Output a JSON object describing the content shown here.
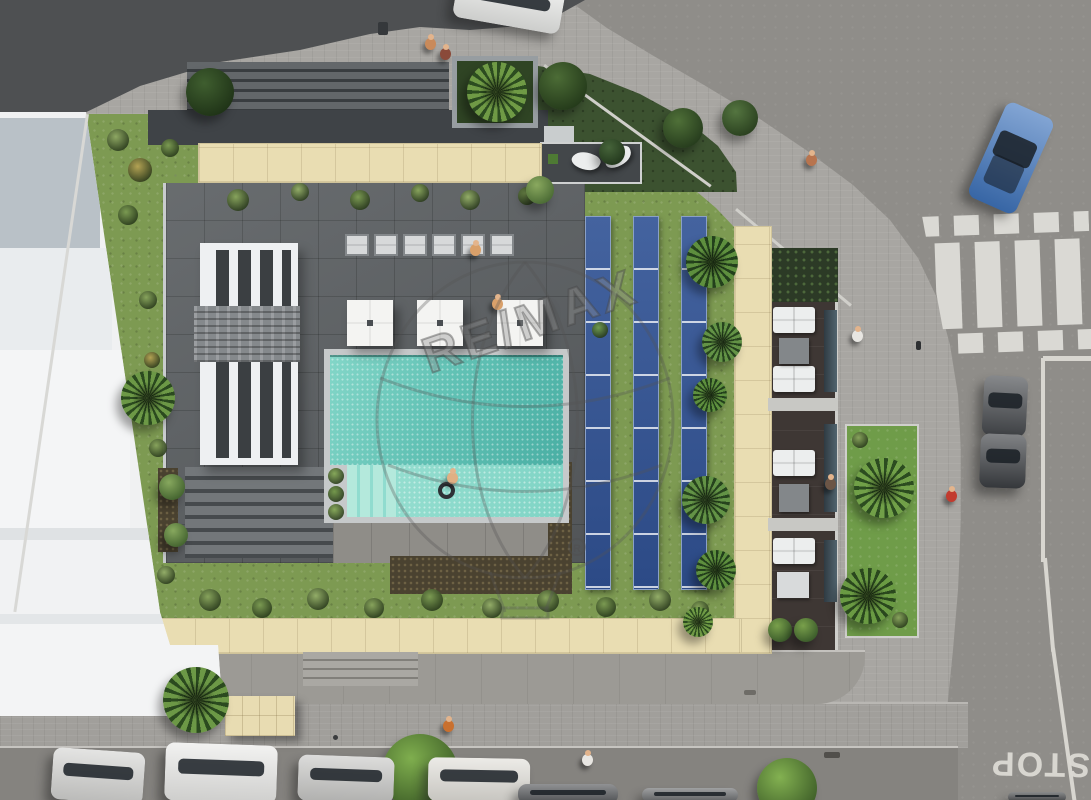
{
  "meta": {
    "description": "Aerial 3D rendering of a residential building with rooftop pool courtyard, solar panels, gardens, sidewalks and street",
    "watermark_text": "RE/MAX",
    "registered_symbol": "R"
  },
  "road_markings": {
    "stop_label": "STOP"
  },
  "palette": {
    "road_asphalt": "#8f8d89",
    "dark_asphalt": "#4e5052",
    "sidewalk": "#a8a6a2",
    "grass_light": "#7d9a52",
    "grass_dark": "#3c5230",
    "beige_tile": "#e9ddb2",
    "pool_deep": "#4aafa4",
    "pool_shallow": "#7fd4c5",
    "deck_tile": "#5d6164",
    "solar_blue": "#35549a",
    "crosswalk_red": "#b76156",
    "marking_white": "#dad9d4",
    "building_white": "#f0f1f2",
    "car_blue": "#3f74bc"
  },
  "crosswalk": {
    "bar_xs": [
      20,
      60,
      100,
      140
    ],
    "square_xs": [
      0,
      40,
      80,
      120,
      160
    ],
    "red": "#b76156",
    "white": "#dad9d4"
  },
  "solar": {
    "strip_xs": [
      585,
      633,
      681
    ],
    "y": 216
  },
  "umbrellas": [
    {
      "x": 347,
      "y": 300
    },
    {
      "x": 417,
      "y": 300
    },
    {
      "x": 497,
      "y": 300
    }
  ],
  "loungers": {
    "y": 234,
    "xs": [
      345,
      374,
      403,
      432,
      461,
      490
    ]
  },
  "leaf_loungers": [
    {
      "x": 572,
      "y": 152,
      "rot": 25
    },
    {
      "x": 604,
      "y": 148,
      "rot": -20
    }
  ],
  "balcony": {
    "sofas": [
      {
        "x": 773,
        "y": 307
      },
      {
        "x": 773,
        "y": 366
      },
      {
        "x": 773,
        "y": 450
      },
      {
        "x": 773,
        "y": 538
      }
    ],
    "tables": [
      {
        "x": 779,
        "y": 338,
        "w": 30,
        "h": 26,
        "c": "#83878a"
      },
      {
        "x": 779,
        "y": 484,
        "w": 30,
        "h": 28,
        "c": "#83878a"
      },
      {
        "x": 777,
        "y": 572,
        "w": 32,
        "h": 26,
        "c": "#d8dadb"
      }
    ],
    "glass": [
      {
        "y": 310,
        "h": 82
      },
      {
        "y": 424,
        "h": 88
      },
      {
        "y": 540,
        "h": 62
      }
    ],
    "walls_y": [
      398,
      518
    ]
  },
  "trees": [
    {
      "x": 210,
      "y": 92,
      "r": 24,
      "kind": "bush",
      "c1": "#3f5e2f",
      "c2": "#1f3317"
    },
    {
      "x": 563,
      "y": 86,
      "r": 24,
      "kind": "bush",
      "c1": "#4c6c36",
      "c2": "#243a1a"
    },
    {
      "x": 612,
      "y": 152,
      "r": 13,
      "kind": "bush",
      "c1": "#46643a",
      "c2": "#22371c"
    },
    {
      "x": 683,
      "y": 128,
      "r": 20,
      "kind": "bush",
      "c1": "#4f7038",
      "c2": "#263c1d"
    },
    {
      "x": 740,
      "y": 118,
      "r": 18,
      "kind": "bush",
      "c1": "#547540",
      "c2": "#2a401f"
    },
    {
      "x": 497,
      "y": 92,
      "r": 30,
      "kind": "palm",
      "c1": "#6f9a45",
      "c2": "#2c4c20"
    },
    {
      "x": 148,
      "y": 398,
      "r": 27,
      "kind": "palm",
      "c1": "#6c9846",
      "c2": "#2b4a1f"
    },
    {
      "x": 172,
      "y": 487,
      "r": 13,
      "kind": "bush",
      "c1": "#87a85e",
      "c2": "#43632f"
    },
    {
      "x": 176,
      "y": 535,
      "r": 12,
      "kind": "bush",
      "c1": "#87a85e",
      "c2": "#43632f"
    },
    {
      "x": 712,
      "y": 262,
      "r": 26,
      "kind": "palm",
      "c1": "#5e8f3e",
      "c2": "#23401c"
    },
    {
      "x": 722,
      "y": 342,
      "r": 20,
      "kind": "palm",
      "c1": "#639346",
      "c2": "#27441e"
    },
    {
      "x": 710,
      "y": 395,
      "r": 17,
      "kind": "palm",
      "c1": "#5e8f3e",
      "c2": "#23401c"
    },
    {
      "x": 706,
      "y": 500,
      "r": 24,
      "kind": "palm",
      "c1": "#639346",
      "c2": "#27441e"
    },
    {
      "x": 716,
      "y": 570,
      "r": 20,
      "kind": "palm",
      "c1": "#5e8f3e",
      "c2": "#23401c"
    },
    {
      "x": 698,
      "y": 622,
      "r": 15,
      "kind": "palm",
      "c1": "#6f9a45",
      "c2": "#2c4c20"
    },
    {
      "x": 884,
      "y": 488,
      "r": 30,
      "kind": "palm",
      "c1": "#71a048",
      "c2": "#2c4c20"
    },
    {
      "x": 868,
      "y": 596,
      "r": 28,
      "kind": "palm",
      "c1": "#6a9a43",
      "c2": "#2a481e"
    },
    {
      "x": 196,
      "y": 700,
      "r": 33,
      "kind": "palm",
      "c1": "#6c9846",
      "c2": "#2b4a1f"
    },
    {
      "x": 420,
      "y": 772,
      "r": 38,
      "kind": "tree",
      "c1": "#7fae4e",
      "c2": "#3c5c26"
    },
    {
      "x": 787,
      "y": 788,
      "r": 30,
      "kind": "tree",
      "c1": "#83b151",
      "c2": "#3e5e28"
    },
    {
      "x": 540,
      "y": 190,
      "r": 14,
      "kind": "bush",
      "c1": "#8aa95f",
      "c2": "#4a6a34"
    },
    {
      "x": 780,
      "y": 630,
      "r": 12,
      "kind": "bush",
      "c1": "#79a04b",
      "c2": "#3a5a2a"
    },
    {
      "x": 806,
      "y": 630,
      "r": 12,
      "kind": "bush",
      "c1": "#79a04b",
      "c2": "#3a5a2a"
    }
  ],
  "shrubs": [
    {
      "x": 118,
      "y": 140,
      "r": 11,
      "c": "#8ea763"
    },
    {
      "x": 140,
      "y": 170,
      "r": 12,
      "c": "#b3a254"
    },
    {
      "x": 170,
      "y": 148,
      "r": 9,
      "c": "#7b9a52"
    },
    {
      "x": 128,
      "y": 215,
      "r": 10,
      "c": "#7b9a52"
    },
    {
      "x": 238,
      "y": 200,
      "r": 11,
      "c": "#87a35c"
    },
    {
      "x": 300,
      "y": 192,
      "r": 9,
      "c": "#93ad68"
    },
    {
      "x": 360,
      "y": 200,
      "r": 10,
      "c": "#7b9a52"
    },
    {
      "x": 420,
      "y": 193,
      "r": 9,
      "c": "#87a35c"
    },
    {
      "x": 470,
      "y": 200,
      "r": 10,
      "c": "#93ad68"
    },
    {
      "x": 527,
      "y": 196,
      "r": 9,
      "c": "#7b9a52"
    },
    {
      "x": 148,
      "y": 300,
      "r": 9,
      "c": "#87a35c"
    },
    {
      "x": 152,
      "y": 360,
      "r": 8,
      "c": "#b3a254"
    },
    {
      "x": 158,
      "y": 448,
      "r": 9,
      "c": "#87a35c"
    },
    {
      "x": 166,
      "y": 575,
      "r": 9,
      "c": "#93ad68"
    },
    {
      "x": 210,
      "y": 600,
      "r": 11,
      "c": "#87a35c"
    },
    {
      "x": 262,
      "y": 608,
      "r": 10,
      "c": "#7b9a52"
    },
    {
      "x": 318,
      "y": 599,
      "r": 11,
      "c": "#93ad68"
    },
    {
      "x": 374,
      "y": 608,
      "r": 10,
      "c": "#87a35c"
    },
    {
      "x": 432,
      "y": 600,
      "r": 11,
      "c": "#7b9a52"
    },
    {
      "x": 492,
      "y": 608,
      "r": 10,
      "c": "#93ad68"
    },
    {
      "x": 548,
      "y": 601,
      "r": 11,
      "c": "#87a35c"
    },
    {
      "x": 606,
      "y": 607,
      "r": 10,
      "c": "#7b9a52"
    },
    {
      "x": 660,
      "y": 600,
      "r": 11,
      "c": "#93ad68"
    },
    {
      "x": 700,
      "y": 610,
      "r": 9,
      "c": "#87a35c"
    },
    {
      "x": 336,
      "y": 476,
      "r": 8,
      "c": "#86a85a"
    },
    {
      "x": 336,
      "y": 494,
      "r": 8,
      "c": "#74984c"
    },
    {
      "x": 336,
      "y": 512,
      "r": 8,
      "c": "#86a85a"
    },
    {
      "x": 600,
      "y": 330,
      "r": 8,
      "c": "#6f9a4f"
    },
    {
      "x": 860,
      "y": 440,
      "r": 8,
      "c": "#87a35c"
    },
    {
      "x": 900,
      "y": 620,
      "r": 8,
      "c": "#87a35c"
    }
  ],
  "people": [
    {
      "x": 425,
      "y": 34,
      "c": "#c98a5a"
    },
    {
      "x": 440,
      "y": 44,
      "c": "#8a4a3a"
    },
    {
      "x": 806,
      "y": 150,
      "c": "#b8744e"
    },
    {
      "x": 852,
      "y": 326,
      "c": "#e8e6e2"
    },
    {
      "x": 825,
      "y": 474,
      "c": "#6b5546"
    },
    {
      "x": 946,
      "y": 486,
      "c": "#c23b2e"
    },
    {
      "x": 582,
      "y": 750,
      "c": "#e8e6e2"
    },
    {
      "x": 443,
      "y": 716,
      "c": "#c9702f"
    },
    {
      "x": 470,
      "y": 240,
      "c": "#d9a06a"
    },
    {
      "x": 492,
      "y": 294,
      "c": "#d9a06a"
    },
    {
      "x": 447,
      "y": 468,
      "c": "#e0b084"
    }
  ],
  "objects": [
    {
      "x": 378,
      "y": 22,
      "w": 10,
      "h": 13,
      "c": "#35383b",
      "name": "trash-bin"
    },
    {
      "x": 916,
      "y": 341,
      "w": 5,
      "h": 9,
      "c": "#2e3032",
      "name": "bollard"
    },
    {
      "x": 333,
      "y": 735,
      "w": 5,
      "h": 5,
      "c": "#3a3c3e",
      "name": "bollard"
    },
    {
      "x": 824,
      "y": 752,
      "w": 16,
      "h": 6,
      "c": "#514f4b",
      "name": "drain-grate"
    },
    {
      "x": 744,
      "y": 690,
      "w": 12,
      "h": 5,
      "c": "#6e6c67",
      "name": "drain-grate"
    }
  ],
  "cars": [
    {
      "x": 455,
      "y": -20,
      "w": 108,
      "h": 46,
      "rot": 10,
      "body": "#e9eae8",
      "name": "white-car-top"
    },
    {
      "x": 985,
      "y": 106,
      "w": 52,
      "h": 104,
      "rot": 24,
      "body": "#3f74bc",
      "name": "blue-car"
    },
    {
      "x": 983,
      "y": 376,
      "w": 44,
      "h": 60,
      "rot": 3,
      "body": "#46494d",
      "name": "dark-car"
    },
    {
      "x": 980,
      "y": 434,
      "w": 46,
      "h": 54,
      "rot": 2,
      "body": "#3c3f43",
      "name": "dark-car"
    },
    {
      "x": 52,
      "y": 750,
      "w": 92,
      "h": 52,
      "rot": 4,
      "body": "#d5d5d3",
      "name": "parked-car"
    },
    {
      "x": 165,
      "y": 744,
      "w": 112,
      "h": 58,
      "rot": 2,
      "body": "#ebebe9",
      "name": "parked-car"
    },
    {
      "x": 298,
      "y": 756,
      "w": 96,
      "h": 46,
      "rot": 2,
      "body": "#c9c9c7",
      "name": "parked-car"
    },
    {
      "x": 428,
      "y": 758,
      "w": 102,
      "h": 44,
      "rot": 1,
      "body": "#e2e0da",
      "name": "parked-car"
    },
    {
      "x": 518,
      "y": 784,
      "w": 100,
      "h": 20,
      "rot": 0,
      "body": "#55575a",
      "name": "parked-car"
    },
    {
      "x": 642,
      "y": 788,
      "w": 96,
      "h": 14,
      "rot": 0,
      "body": "#6b6d6f",
      "name": "parked-car"
    },
    {
      "x": 1008,
      "y": 792,
      "w": 58,
      "h": 10,
      "rot": 0,
      "body": "#4a4c4e",
      "name": "parked-car"
    }
  ]
}
